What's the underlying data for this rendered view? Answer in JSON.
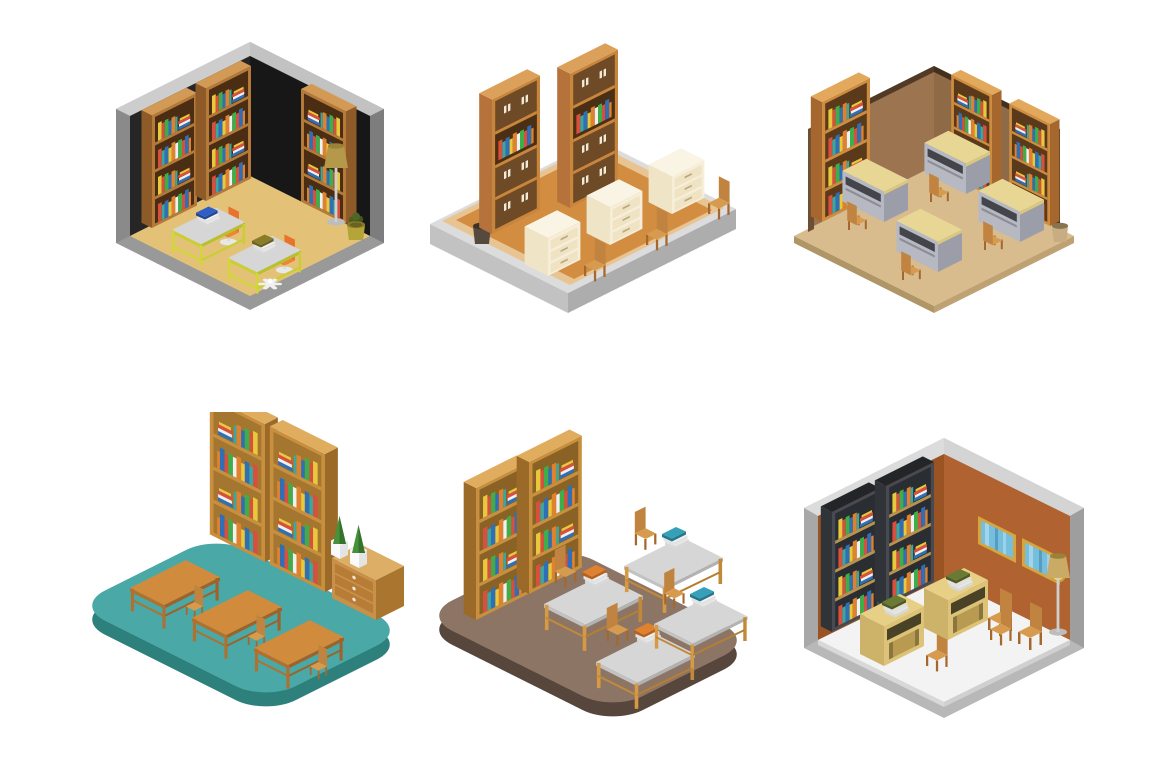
{
  "artwork": {
    "title": "Isometric library rooms illustration set",
    "layout": "2 rows x 3 columns of isometric room vignettes",
    "background_color": "#ffffff"
  },
  "scenes": [
    {
      "id": "room-1",
      "name": "dark-walled library corner room",
      "position": "top-left",
      "floor_color": "#e3c278",
      "wall_color": "#232323",
      "shell_color": "#999999",
      "furniture": [
        "three wooden bookshelves with colorful books",
        "two yellow-frame desks with gray tops",
        "blue book stack on desk",
        "olive book stack on desk",
        "two orange office chairs",
        "white swivel chair base",
        "floor lamp",
        "potted plant"
      ]
    },
    {
      "id": "room-2",
      "name": "open platform library",
      "position": "top-center",
      "floor_color": "#d28d41",
      "platform_color": "#dcdcdc",
      "furniture": [
        "two tall brown cabinet bookcases with one open book shelf each",
        "three cream drawer desks",
        "three wooden chairs",
        "dark trash bin"
      ]
    },
    {
      "id": "room-3",
      "name": "brown-walled reading room",
      "position": "top-right",
      "floor_color": "#d8bc8e",
      "wall_color": "#9c7450",
      "trim_color": "#513a26",
      "furniture": [
        "three orange bookcases filled with colorful books",
        "four study desks with khaki tops",
        "four wooden chairs",
        "tan waste basket"
      ]
    },
    {
      "id": "room-4",
      "name": "teal floor classroom",
      "position": "bottom-left",
      "floor_color": "#4aa9a6",
      "furniture": [
        "two golden bookshelves with colorful books",
        "three wooden tables",
        "three wooden chairs",
        "wooden drawer chest",
        "two white planters with cypress plants"
      ]
    },
    {
      "id": "room-5",
      "name": "brown floor study hall",
      "position": "bottom-center",
      "floor_color": "#8d7566",
      "furniture": [
        "two golden bookshelves packed with books",
        "four gray-top tables with golden legs",
        "four wooden chairs",
        "orange and teal book stacks on tables"
      ]
    },
    {
      "id": "room-6",
      "name": "rust-walled library room",
      "position": "bottom-right",
      "floor_color": "#f3f3f3",
      "wall_color": "#b06230",
      "shell_color": "#c2c2c2",
      "furniture": [
        "two dark gray bookcases with colorful books",
        "two gold-framed windows",
        "gold wall clock",
        "two tan desks with book stacks",
        "four wooden chairs",
        "floor lamp"
      ]
    }
  ],
  "palette": {
    "book_colors": [
      "#d94f3d",
      "#2f6fb8",
      "#3fae49",
      "#e8c93e",
      "#e0812e",
      "#3aa89f",
      "#f0f0f0"
    ],
    "wood": "#c8903e",
    "dark_wood": "#6f4a26",
    "cream": "#f2e9cf",
    "chair_wood": "#d79b4f"
  }
}
